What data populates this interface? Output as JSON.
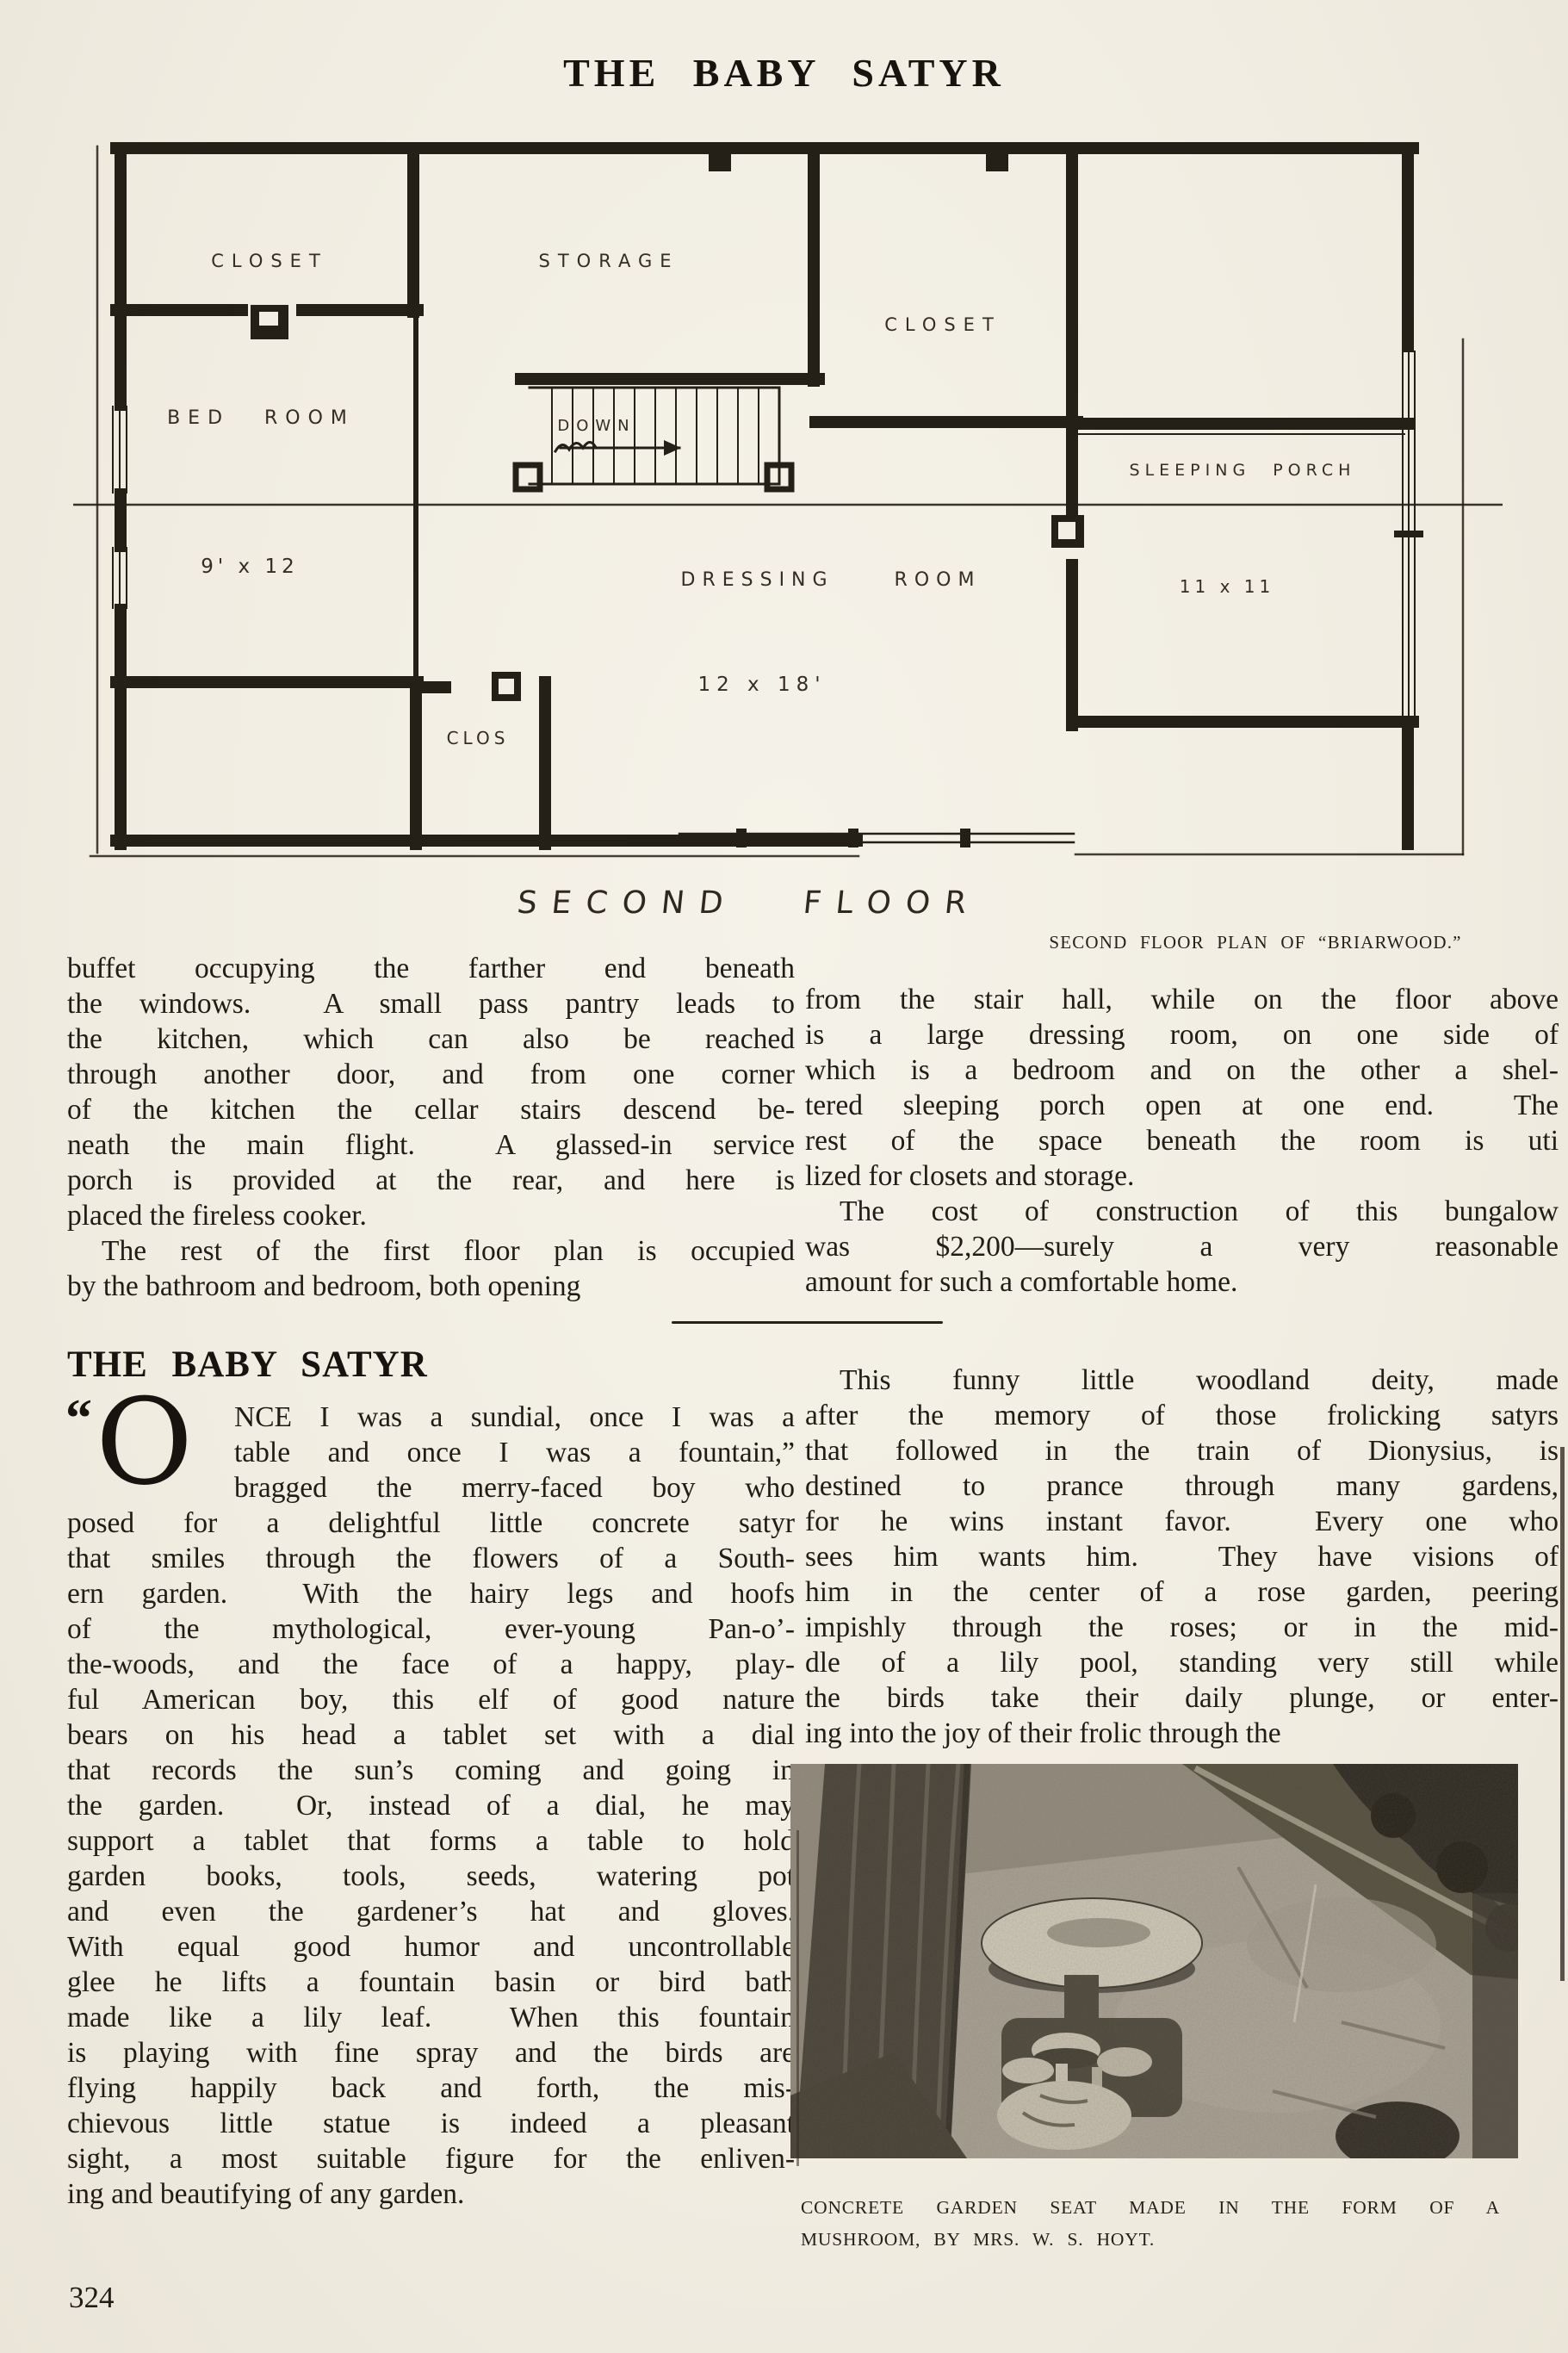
{
  "page": {
    "title": "THE BABY SATYR",
    "page_number": "324"
  },
  "plan": {
    "labels": {
      "closet_left": "CLOSET",
      "storage": "STORAGE",
      "closet_right": "CLOSET",
      "bed_room": "BED ROOM",
      "bed_dim": "9' x 12",
      "down": "DOWN",
      "dressing_room": "DRESSING ROOM",
      "dressing_dim": "12 x 18'",
      "clos": "CLOS",
      "sleeping_porch": "SLEEPING PORCH",
      "porch_dim": "11 x 11",
      "floor_label": "SECOND FLOOR"
    },
    "caption": "SECOND FLOOR PLAN OF “BRIARWOOD.”"
  },
  "sections": {
    "heading": "THE BABY SATYR"
  },
  "dropcap": {
    "quote": "“",
    "letter": "O"
  },
  "columns": {
    "left_top": [
      {
        "t": "buffet occupying the farther end beneath",
        "c": "j"
      },
      {
        "t": "the windows.  A small pass pantry leads to",
        "c": "j"
      },
      {
        "t": "the kitchen, which can also be reached",
        "c": "j"
      },
      {
        "t": "through another door, and from one corner",
        "c": "j"
      },
      {
        "t": "of the kitchen the cellar stairs descend be-",
        "c": "j"
      },
      {
        "t": "neath the main flight.  A glassed-in service",
        "c": "j"
      },
      {
        "t": "porch is provided at the rear, and here is",
        "c": "j"
      },
      {
        "t": "placed the fireless cooker.",
        "c": "last"
      },
      {
        "t": "The rest of the first floor plan is occupied",
        "c": "j ind"
      },
      {
        "t": "by the bathroom and bedroom, both opening",
        "c": "last"
      }
    ],
    "right_top": [
      {
        "t": "from the stair hall, while on the floor above",
        "c": "j"
      },
      {
        "t": "is a large dressing room, on one side of",
        "c": "j"
      },
      {
        "t": "which is a bedroom and on the other a shel-",
        "c": "j"
      },
      {
        "t": "tered sleeping porch open at one end.  The",
        "c": "j"
      },
      {
        "t": "rest of the space beneath the room is uti",
        "c": "j"
      },
      {
        "t": "lized for closets and storage.",
        "c": "last"
      },
      {
        "t": "The cost of construction of this bungalow",
        "c": "j ind"
      },
      {
        "t": "was $2,200—surely a very reasonable",
        "c": "j"
      },
      {
        "t": "amount for such a comfortable home.",
        "c": "last"
      }
    ],
    "left_body": [
      {
        "t": "NCE I was a sundial, once I was a",
        "c": "j ind3"
      },
      {
        "t": "table and once I was a fountain,”",
        "c": "j ind3"
      },
      {
        "t": "bragged the merry-faced boy who",
        "c": "j ind3"
      },
      {
        "t": "posed for a delightful little concrete satyr",
        "c": "j"
      },
      {
        "t": "that smiles through the flowers of a South-",
        "c": "j"
      },
      {
        "t": "ern garden.  With the hairy legs and hoofs",
        "c": "j"
      },
      {
        "t": "of the mythological, ever-young Pan-o’-",
        "c": "j"
      },
      {
        "t": "the-woods, and the face of a happy, play-",
        "c": "j"
      },
      {
        "t": "ful American boy, this elf of good nature",
        "c": "j"
      },
      {
        "t": "bears on his head a tablet set with a dial",
        "c": "j"
      },
      {
        "t": "that records the sun’s coming and going in",
        "c": "j"
      },
      {
        "t": "the garden.  Or, instead of a dial, he may",
        "c": "j"
      },
      {
        "t": "support a tablet that forms a table to hold",
        "c": "j"
      },
      {
        "t": "garden books, tools, seeds, watering pot",
        "c": "j"
      },
      {
        "t": "and even the gardener’s hat and gloves.",
        "c": "j"
      },
      {
        "t": "With equal good humor and uncontrollable",
        "c": "j"
      },
      {
        "t": "glee he lifts a fountain basin or bird bath",
        "c": "j"
      },
      {
        "t": "made like a lily leaf.  When this fountain",
        "c": "j"
      },
      {
        "t": "is playing with fine spray and the birds are",
        "c": "j"
      },
      {
        "t": "flying happily back and forth, the mis-",
        "c": "j"
      },
      {
        "t": "chievous little statue is indeed a pleasant",
        "c": "j"
      },
      {
        "t": "sight, a most suitable figure for the enliven-",
        "c": "j"
      },
      {
        "t": "ing and beautifying of any garden.",
        "c": "last"
      }
    ],
    "right_body": [
      {
        "t": "This funny little woodland deity, made",
        "c": "j ind"
      },
      {
        "t": "after the memory of those frolicking satyrs",
        "c": "j"
      },
      {
        "t": "that followed in the train of Dionysius, is",
        "c": "j"
      },
      {
        "t": "destined to prance through many gardens,",
        "c": "j"
      },
      {
        "t": "for he wins instant favor.  Every one who",
        "c": "j"
      },
      {
        "t": "sees him wants him.  They have visions of",
        "c": "j"
      },
      {
        "t": "him in the center of a rose garden, peering",
        "c": "j"
      },
      {
        "t": "impishly through the roses; or in the mid-",
        "c": "j"
      },
      {
        "t": "dle of a lily pool, standing very still while",
        "c": "j"
      },
      {
        "t": "the birds take their daily plunge, or enter-",
        "c": "j"
      },
      {
        "t": "ing into the joy of their frolic through the",
        "c": "last"
      }
    ]
  },
  "photo": {
    "caption_line1": "CONCRETE GARDEN SEAT MADE IN THE FORM OF A",
    "caption_line2": "MUSHROOM, BY MRS. W. S. HOYT."
  }
}
